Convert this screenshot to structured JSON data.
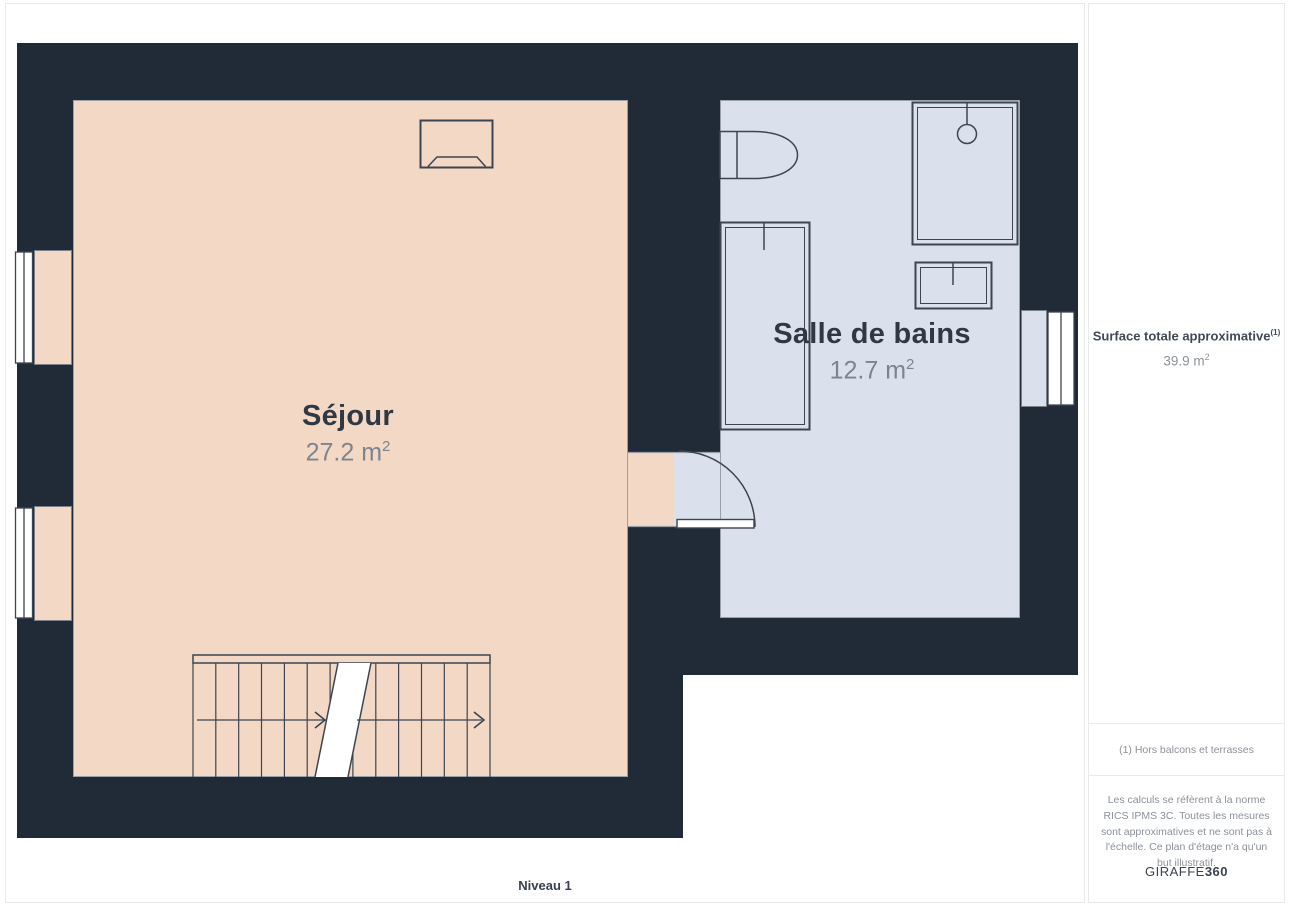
{
  "plan": {
    "level_label": "Niveau 1",
    "rooms": [
      {
        "name": "Séjour",
        "area_value": "27.2 m",
        "area_sup": "2"
      },
      {
        "name": "Salle de bains",
        "area_value": "12.7 m",
        "area_sup": "2"
      }
    ],
    "fixtures": [
      "fireplace",
      "staircase",
      "toilet",
      "bathtub",
      "shower",
      "sink",
      "door",
      "window",
      "window",
      "window"
    ]
  },
  "sidebar": {
    "title": "Surface totale approximative",
    "title_sup": "(1)",
    "total_value": "39.9 m",
    "total_sup": "2",
    "note": "(1) Hors balcons et terrasses",
    "disclaimer": "Les calculs se réfèrent à la norme RICS IPMS 3C. Toutes les mesures sont approximatives et ne sont pas à l'échelle. Ce plan d'étage n'a qu'un but illustratif.",
    "brand_name": "GIRAFFE",
    "brand_suffix": "360"
  },
  "colors": {
    "wall": "#212b37",
    "sejour_floor": "#f3d8c5",
    "bath_floor": "#dbe1ec",
    "fixture_line": "#3d4550",
    "floor_border": "#99a0aa"
  }
}
